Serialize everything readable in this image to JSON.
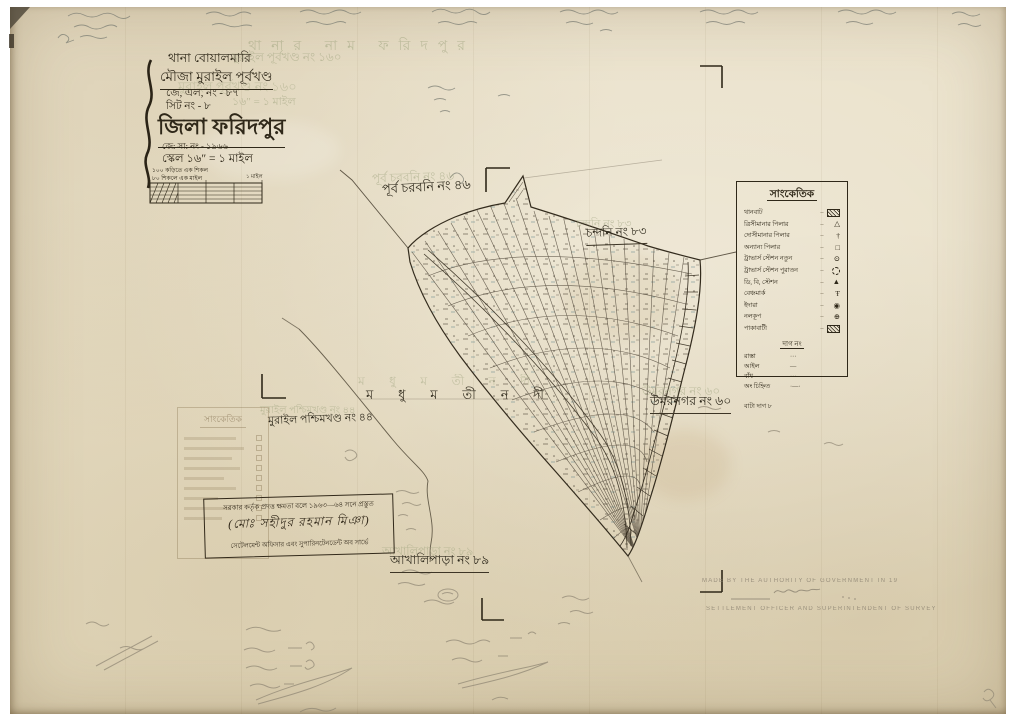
{
  "sheet": {
    "title_block": {
      "thana_line": "থানা   বোয়ালমারি",
      "mouza_line": "মৌজা   মুরাইল পূর্বখণ্ড",
      "jl_line": "জে, এল, নং - ৮৭",
      "sheet_line": "সিট নং - ৮",
      "district_line": "জিলা   ফরিদপুর",
      "js_line": "জে: সা: নং - ১৯৬৬",
      "scale_line": "স্কেল ১৬″ = ১ মাইল",
      "scale_note_1": "১০০ কড়িতে এক শিকল",
      "scale_note_2": "৮০ শিকলে এক মাইল",
      "scale_bar_label": "১ মাইল"
    },
    "ghosts": {
      "g1": "মুরাইল পূর্বখণ্ড নং ১৬০",
      "g2": "১৬″ = ১ মাইল",
      "g3": "থানার নাম   ফরিদপুর"
    },
    "map_labels": {
      "north": "পূর্ব চরবনি নং ৪৬",
      "east_top": "চন্দনি নং ৮৩",
      "east": "উমরনগর নং ৬০",
      "west": "মুরাইল পশ্চিমখণ্ড নং ৪৪",
      "south": "আখালিপাড়া নং ৮৯",
      "river_letters": [
        "ম",
        "ধু",
        "ম",
        "তী",
        "ন",
        "দী"
      ]
    },
    "legend": {
      "title": "সাংকেতিক",
      "leader": "–",
      "items": [
        {
          "label": "থানবাট",
          "symbol": "hatch-box"
        },
        {
          "label": "ত্রিসীমানার পিলার",
          "symbol": "triangle"
        },
        {
          "label": "দোসীমানার পিলার",
          "symbol": "cross"
        },
        {
          "label": "অন্যান্য পিলার",
          "symbol": "square"
        },
        {
          "label": "ট্রাভার্স স্টেশন নতুন",
          "symbol": "circle-dot"
        },
        {
          "label": "ট্রাভার্স স্টেশন পুরাতন",
          "symbol": "circle-dashed"
        },
        {
          "label": "ডি, বি, স্টেশন",
          "symbol": "triangle-filled"
        },
        {
          "label": "বেঞ্চমার্ক",
          "symbol": "benchmark"
        },
        {
          "label": "ইদারা",
          "symbol": "circle-filled"
        },
        {
          "label": "নলকূপ",
          "symbol": "circle-plus"
        },
        {
          "label": "পাকাবাটী",
          "symbol": "hatch-box"
        }
      ],
      "sub_title": "দাগ নং",
      "line_items": [
        {
          "label": "রাস্তা",
          "mark": "···"
        },
        {
          "label": "আইল",
          "mark": "—"
        },
        {
          "label": "বাঁধ",
          "mark": "···"
        },
        {
          "label": "অং চিহ্নিত",
          "mark": "·—·"
        }
      ],
      "footer": "বাটা দাগ ৮"
    },
    "stamp_box": {
      "line1": "সরকার কর্তৃক প্রদত্ত ক্ষমতা বলে ১৯৬৩—৬৪ সনে প্রস্তুত",
      "line2": "(মোঃ সহীদুর রহমান মিঞা)",
      "line3": "সেটেলমেন্ট অফিসার এবং সুপারিনটেনডেন্ট অব সার্ভে"
    },
    "pencil_en": {
      "line1": "MADE BY THE AUTHORITY OF GOVERNMENT IN 19",
      "line3": "SETTLEMENT OFFICER AND SUPERINTENDENT OF SURVEY"
    },
    "colors": {
      "paper": "#eae1ca",
      "ink": "#2f2819",
      "pencil": "#8d8472",
      "ghost": "#9aa07a",
      "teal": "#5b7f86"
    }
  }
}
